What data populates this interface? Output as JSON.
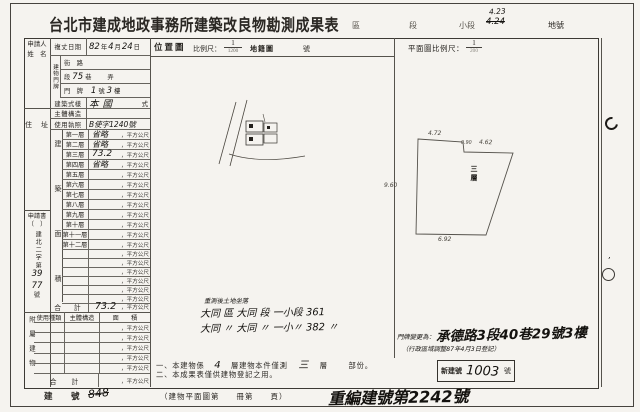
{
  "colors": {
    "paper": "#f5f3ef",
    "ink": "#23201c",
    "line": "#55524c"
  },
  "header": {
    "title": "台北市建成地政事務所建築改良物勘測成果表",
    "district_label": "區",
    "section_label": "段",
    "subsection_label": "小段",
    "parcel_top": "4.23",
    "parcel_bottom": "4.24",
    "parcel_label": "地號"
  },
  "leftcol": {
    "applicant_l1": "申請人",
    "applicant_l2": "姓　名",
    "address_label": "住　址",
    "appdoc_l1": "申請書",
    "appdoc_l2": "（　）",
    "appdoc_l3": "建北二字第",
    "appdoc_hand1": "39",
    "appdoc_hand2": "77",
    "appdoc_l4": "號",
    "annex_vertical": "附屬建物"
  },
  "survey": {
    "label": "複丈日期",
    "y": "82",
    "y_unit": "年",
    "m": "4",
    "m_unit": "月",
    "d": "24",
    "d_unit": "日"
  },
  "doorplate": {
    "group": "建物門牌",
    "street": "街　路",
    "seg": "段",
    "seg_hand": "75",
    "lane": "巷",
    "alley": "弄",
    "door_label": "門　牌",
    "no_hand": "1",
    "no_unit": "號",
    "fl_hand": "3",
    "fl_unit": "樓"
  },
  "inforows": {
    "style_label": "建築式樣",
    "style_hand": "本國",
    "style_suffix": "式",
    "structure_label": "主體構造",
    "license_label": "使用執照",
    "license_hand": "B使字1240號"
  },
  "floors": {
    "strip": "建築面積",
    "unit": "，平方公尺",
    "rows": [
      {
        "label": "第一層",
        "hand": "省略"
      },
      {
        "label": "第二層",
        "hand": "省略"
      },
      {
        "label": "第三層",
        "hand": "73.2"
      },
      {
        "label": "第四層",
        "hand": "省略"
      },
      {
        "label": "第五層",
        "hand": ""
      },
      {
        "label": "第六層",
        "hand": ""
      },
      {
        "label": "第七層",
        "hand": ""
      },
      {
        "label": "第八層",
        "hand": ""
      },
      {
        "label": "第九層",
        "hand": ""
      },
      {
        "label": "第十層",
        "hand": ""
      },
      {
        "label": "第十一層",
        "hand": ""
      },
      {
        "label": "第十二層",
        "hand": ""
      },
      {
        "label": "",
        "hand": ""
      },
      {
        "label": "",
        "hand": ""
      },
      {
        "label": "",
        "hand": ""
      },
      {
        "label": "",
        "hand": ""
      },
      {
        "label": "",
        "hand": ""
      },
      {
        "label": "",
        "hand": ""
      }
    ],
    "total_label": "合　計",
    "total_hand": "73.2"
  },
  "annex": {
    "h1": "使用種類",
    "h2": "主體構造",
    "h3": "面　　積",
    "unit": "，平方公尺",
    "total_label": "合　計"
  },
  "locmap": {
    "name": "位置圖",
    "scale_label": "比例尺：",
    "num": "1",
    "den": "1200",
    "map_label": "地籍圖",
    "no_label": "號"
  },
  "plan": {
    "scale_label": "平面圖比例尺：",
    "num": "1",
    "den": "200",
    "floor_label": "三層",
    "dim_top": "4.72",
    "dim_step": "0.90",
    "dim_tr": "4.62",
    "dim_left": "9.60",
    "dim_bottom": "6.92"
  },
  "resurvey": {
    "caption": "重測後土地坐落",
    "line1": "大同 區 大同 段 一小段 361",
    "line2": "大同 〃 大同 〃 一小〃 382 〃"
  },
  "doorchange": {
    "prefix": "門牌變更為：",
    "address": "承德路3段40巷29號3樓",
    "note": "（行政區域調整87年4月3日登記）"
  },
  "notes": {
    "n1a": "一、本建物係",
    "n1h1": "4",
    "n1b": "層建物本件僅測",
    "n1h2": "三",
    "n1c": "層",
    "n1d": "部份。",
    "n2": "二、本成果表僅供建物登記之用。"
  },
  "newno": {
    "label": "新建號",
    "hand": "1003",
    "suffix": "號"
  },
  "bottom": {
    "label": "建　號",
    "hand": "848",
    "planref": "（建物平面圖第　　冊第　　頁）",
    "renumber": "重編建號第2242號"
  }
}
